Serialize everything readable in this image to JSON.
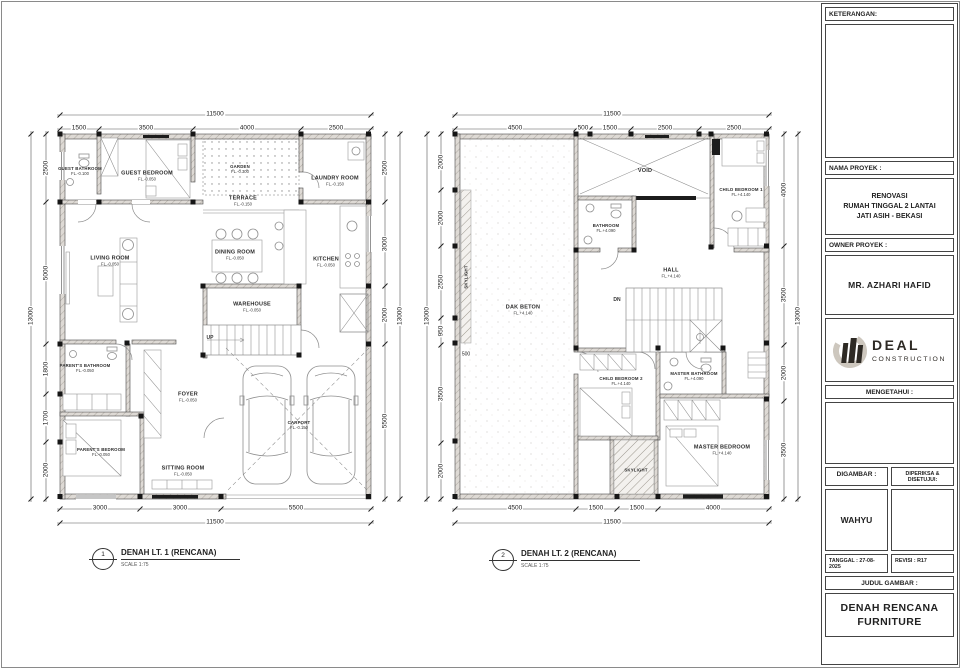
{
  "sheet": {
    "titles": {
      "floor1_num": "1",
      "floor1_title": "DENAH LT. 1 (RENCANA)",
      "floor1_scale": "SCALE 1:75",
      "floor2_num": "2",
      "floor2_title": "DENAH LT. 2 (RENCANA)",
      "floor2_scale": "SCALE 1:75"
    },
    "colors": {
      "wall_fill": "#dedad5",
      "ink": "#3c3c3c",
      "column": "#161616",
      "logo": "#2e2a25"
    }
  },
  "floor1": {
    "stair_label": "UP",
    "rooms": [
      {
        "name": "GUEST BATHROOM",
        "level": "FL.-0.100"
      },
      {
        "name": "GUEST BEDROOM",
        "level": "FL.-0.050"
      },
      {
        "name": "GARDEN",
        "level": "FL.-0.300"
      },
      {
        "name": "TERRACE",
        "level": "FL.-0.150"
      },
      {
        "name": "LAUNDRY ROOM",
        "level": "FL.-0.150"
      },
      {
        "name": "LIVING ROOM",
        "level": "FL.-0.050"
      },
      {
        "name": "DINING ROOM",
        "level": "FL.-0.050"
      },
      {
        "name": "KITCHEN",
        "level": "FL.-0.050"
      },
      {
        "name": "WAREHOUSE",
        "level": "FL.-0.050"
      },
      {
        "name": "PARENT'S BATHROOM",
        "level": "FL.-0.050"
      },
      {
        "name": "FOYER",
        "level": "FL.-0.050"
      },
      {
        "name": "PARENT'S BEDROOM",
        "level": "FL.-0.050"
      },
      {
        "name": "SITTING ROOM",
        "level": "FL.-0.050"
      },
      {
        "name": "CARPORT",
        "level": "FL.-0.150"
      }
    ],
    "dims": {
      "top": [
        "1500",
        "3500",
        "4000",
        "2500"
      ],
      "top_total": "11500",
      "left": [
        "2500",
        "5000",
        "1800",
        "1700",
        "2000"
      ],
      "left_total": "13000",
      "right": [
        "2500",
        "3000",
        "2000",
        "5500"
      ],
      "right_total": "13000",
      "bottom": [
        "3000",
        "3000",
        "5500"
      ],
      "bottom_total": "11500"
    }
  },
  "floor2": {
    "stair_label": "DN",
    "rooms": [
      {
        "name": "VOID",
        "level": ""
      },
      {
        "name": "CHILD BEDROOM 1",
        "level": "FL.+4.140"
      },
      {
        "name": "BATHROOM",
        "level": "FL.+4.090"
      },
      {
        "name": "HALL",
        "level": "FL.+4.140"
      },
      {
        "name": "DAK BETON",
        "level": "FL.+4.140"
      },
      {
        "name": "CHILD BEDROOM 2",
        "level": "FL.+4.140"
      },
      {
        "name": "MASTER BATHROOM",
        "level": "FL.+4.090"
      },
      {
        "name": "MASTER BEDROOM",
        "level": "FL.+4.140"
      },
      {
        "name": "SKYLIGHT",
        "level": ""
      },
      {
        "name": "SKYLIGHT",
        "level": ""
      }
    ],
    "dims": {
      "top": [
        "4500",
        "500",
        "1500",
        "2500",
        "2500"
      ],
      "top_total": "11500",
      "left": [
        "2000",
        "2000",
        "2550",
        "950",
        "3500",
        "2000"
      ],
      "left_total": "13000",
      "right": [
        "4000",
        "3500",
        "2000",
        "3500"
      ],
      "right_total": "13000",
      "bottom": [
        "4500",
        "1500",
        "1500",
        "4000"
      ],
      "bottom_total": "11500",
      "inset": "500"
    }
  },
  "titleblock": {
    "keterangan_label": "KETERANGAN:",
    "nama_proyek_label": "NAMA PROYEK :",
    "project_lines": [
      "RENOVASI",
      "RUMAH TINGGAL 2 LANTAI",
      "JATI ASIH - BEKASI"
    ],
    "owner_label": "OWNER PROYEK :",
    "owner": "MR. AZHARI HAFID",
    "logo_name": "DEAL",
    "logo_sub": "CONSTRUCTION",
    "mengetahui_label": "MENGETAHUI :",
    "digambar_label": "DIGAMBAR :",
    "diperiksa_label": "DIPERIKSA & DISETUJUI:",
    "digambar_value": "WAHYU",
    "tanggal": "TANGGAL : 27-08-2025",
    "revisi": "REVISI : R17",
    "judul_label": "JUDUL GAMBAR :",
    "judul_line1": "DENAH RENCANA",
    "judul_line2": "FURNITURE"
  }
}
